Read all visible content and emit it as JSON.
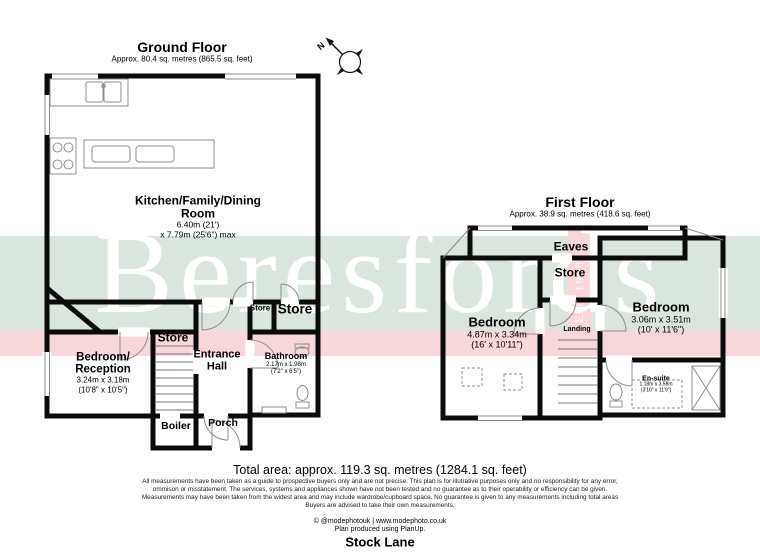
{
  "brand": {
    "watermark": "Beresfords",
    "established": "Est. 1968"
  },
  "compass": {
    "north_label": "N"
  },
  "colors": {
    "band_green": "#d9e5dd",
    "band_pink": "#f8d7da",
    "wall": "#000000"
  },
  "ground_floor": {
    "title": "Ground Floor",
    "subtitle": "Approx. 80.4 sq. metres (865.5 sq. feet)",
    "rooms": {
      "kitchen": {
        "name_lines": [
          "Kitchen/Family/Dining",
          "Room"
        ],
        "dim_metric": "6.40m (21')",
        "dim_imperial": "x 7.79m (25'6\") max"
      },
      "bedroom_reception": {
        "name_lines": [
          "Bedroom/",
          "Reception"
        ],
        "dim_metric": "3.24m x 3.18m",
        "dim_imperial": "(10'8\" x 10'5\")"
      },
      "store_stairs": {
        "name": "Store"
      },
      "entrance_hall": {
        "name_lines": [
          "Entrance",
          "Hall"
        ]
      },
      "store_small": {
        "name": "Store"
      },
      "store_large": {
        "name": "Store"
      },
      "bathroom": {
        "name": "Bathroom",
        "dim_metric": "2.17m x 1.98m",
        "dim_imperial": "(7'2\" x 6'5\")"
      },
      "boiler": {
        "name": "Boiler"
      },
      "porch": {
        "name": "Porch"
      }
    }
  },
  "first_floor": {
    "title": "First Floor",
    "subtitle": "Approx. 38.9 sq. metres (418.6 sq. feet)",
    "rooms": {
      "eaves": {
        "name": "Eaves"
      },
      "store": {
        "name": "Store"
      },
      "bedroom_left": {
        "name": "Bedroom",
        "dim_metric": "4.87m x 3.34m",
        "dim_imperial": "(16' x 10'11\")"
      },
      "landing": {
        "name": "Landing"
      },
      "bedroom_right": {
        "name": "Bedroom",
        "dim_metric": "3.06m x 3.51m",
        "dim_imperial": "(10' x 11'6\")"
      },
      "ensuite": {
        "name": "En-suite",
        "dim_metric": "1.18m x 3.58m",
        "dim_imperial": "(3'10\" x 11'9\")"
      }
    }
  },
  "footer": {
    "total_area": "Total area: approx. 119.3 sq. metres (1284.1 sq. feet)",
    "disclaimer": [
      "All measurements have been taken as a guide to prospective buyers only and are not precise. This plan is for illutrative purposes only and no responsibility for any error,",
      "ommison or misstatement. The services, systems and appliances shown have not been tested and no guarantee as to their operability or efficiency can be given.",
      "Measurements may have been taken from the widest area and may include wardrobe/cupboard space. No guarantee is given to any measurements including total areas",
      "Buyers are advised to take their own measurements."
    ],
    "credit": "© @modephotouk | www.modephoto.co.uk",
    "software": "Plan produced using PlanUp.",
    "address": "Stock Lane"
  }
}
